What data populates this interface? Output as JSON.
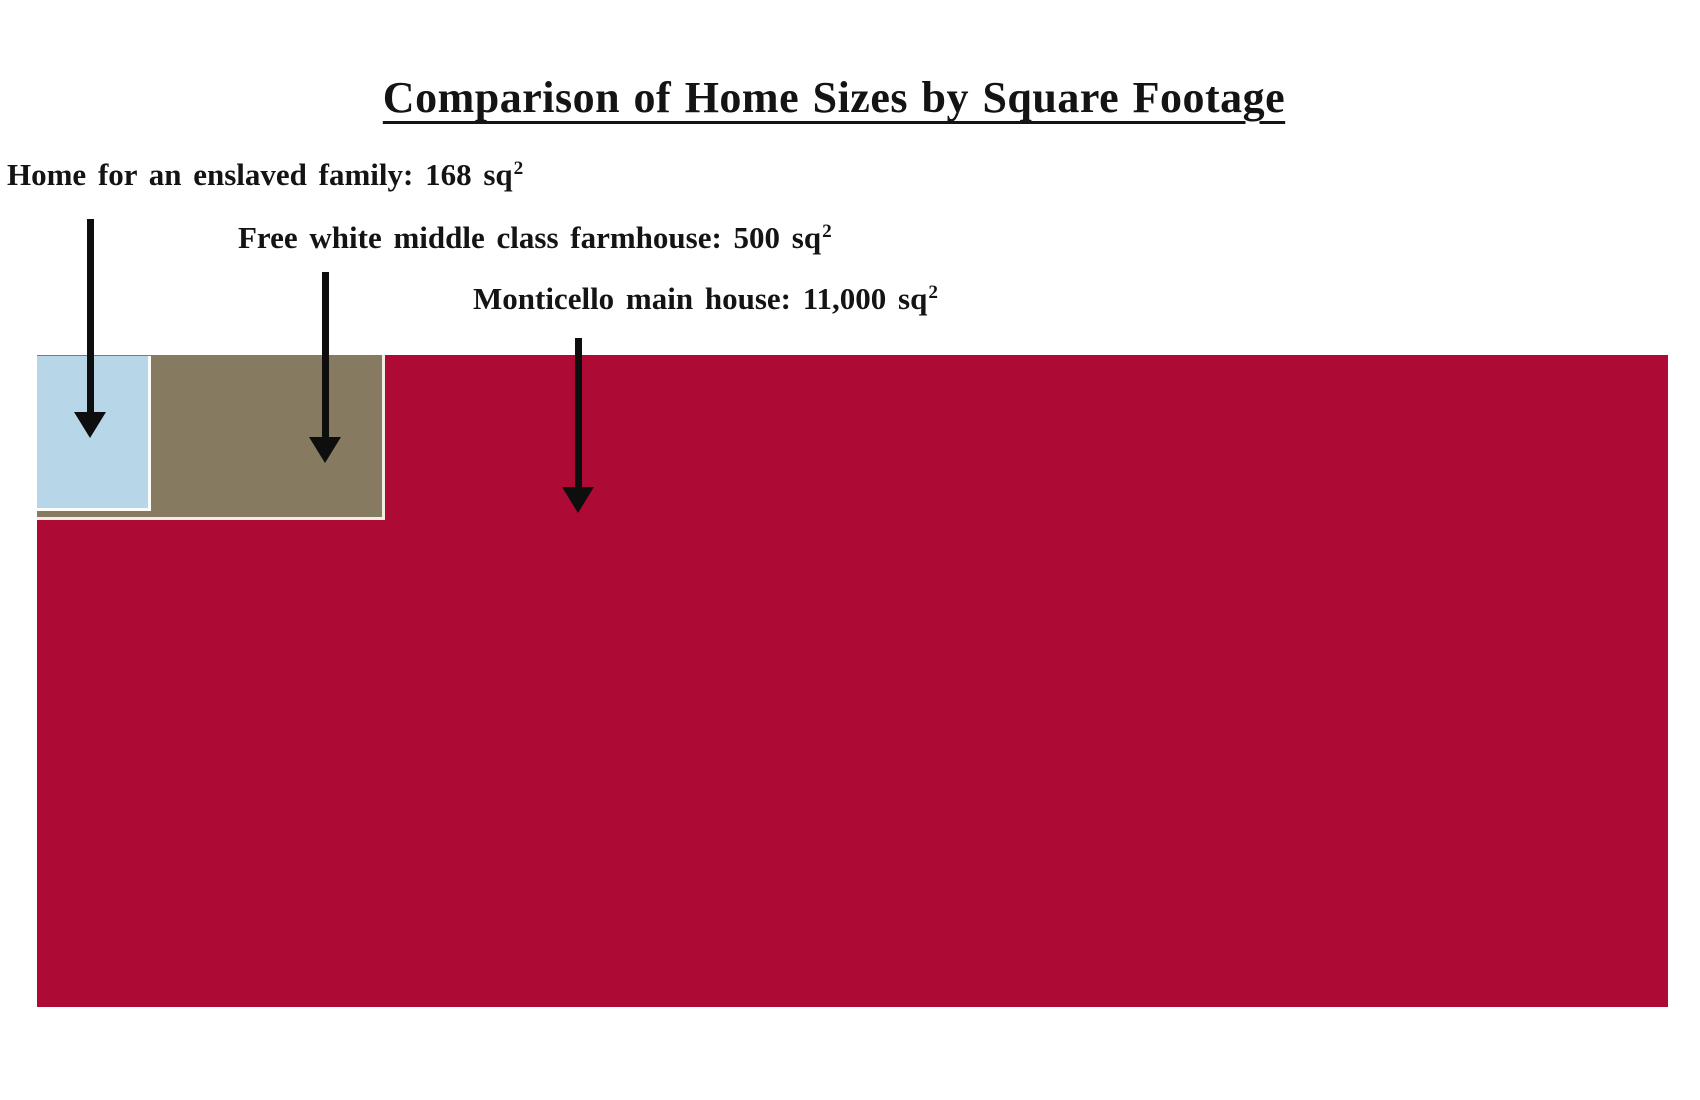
{
  "title": {
    "text": "Comparison of Home Sizes by Square Footage"
  },
  "chart_data": {
    "type": "area",
    "variant": "nested proportional rectangles (area comparison, anchored top-left)",
    "title": "Comparison of Home Sizes by Square Footage",
    "categories": [
      "Home for an enslaved family",
      "Free white middle class farmhouse",
      "Monticello main house"
    ],
    "values": [
      168,
      500,
      11000
    ],
    "unit": "sq²",
    "series": [
      {
        "name": "Home for an enslaved family",
        "value": 168,
        "color": "#B7D7E9"
      },
      {
        "name": "Free white middle class farmhouse",
        "value": 500,
        "color": "#867B60"
      },
      {
        "name": "Monticello main house",
        "value": 11000,
        "color": "#AE0A36"
      }
    ],
    "legend_position": "annotated labels with arrows",
    "grid": false,
    "axes": false
  },
  "annotations": [
    {
      "text": "Home for an enslaved family: 168 sq",
      "sup": "2"
    },
    {
      "text": "Free white middle class farmhouse: 500 sq",
      "sup": "2"
    },
    {
      "text": "Monticello main house: 11,000 sq",
      "sup": "2"
    }
  ],
  "colors": {
    "enslaved_home": "#B7D7E9",
    "farmhouse": "#867B60",
    "monticello": "#AE0A36",
    "rect_outline_cream": "#F1EDE0",
    "arrow": "#0E0E0E",
    "background": "#FFFFFF",
    "text": "#141414"
  }
}
